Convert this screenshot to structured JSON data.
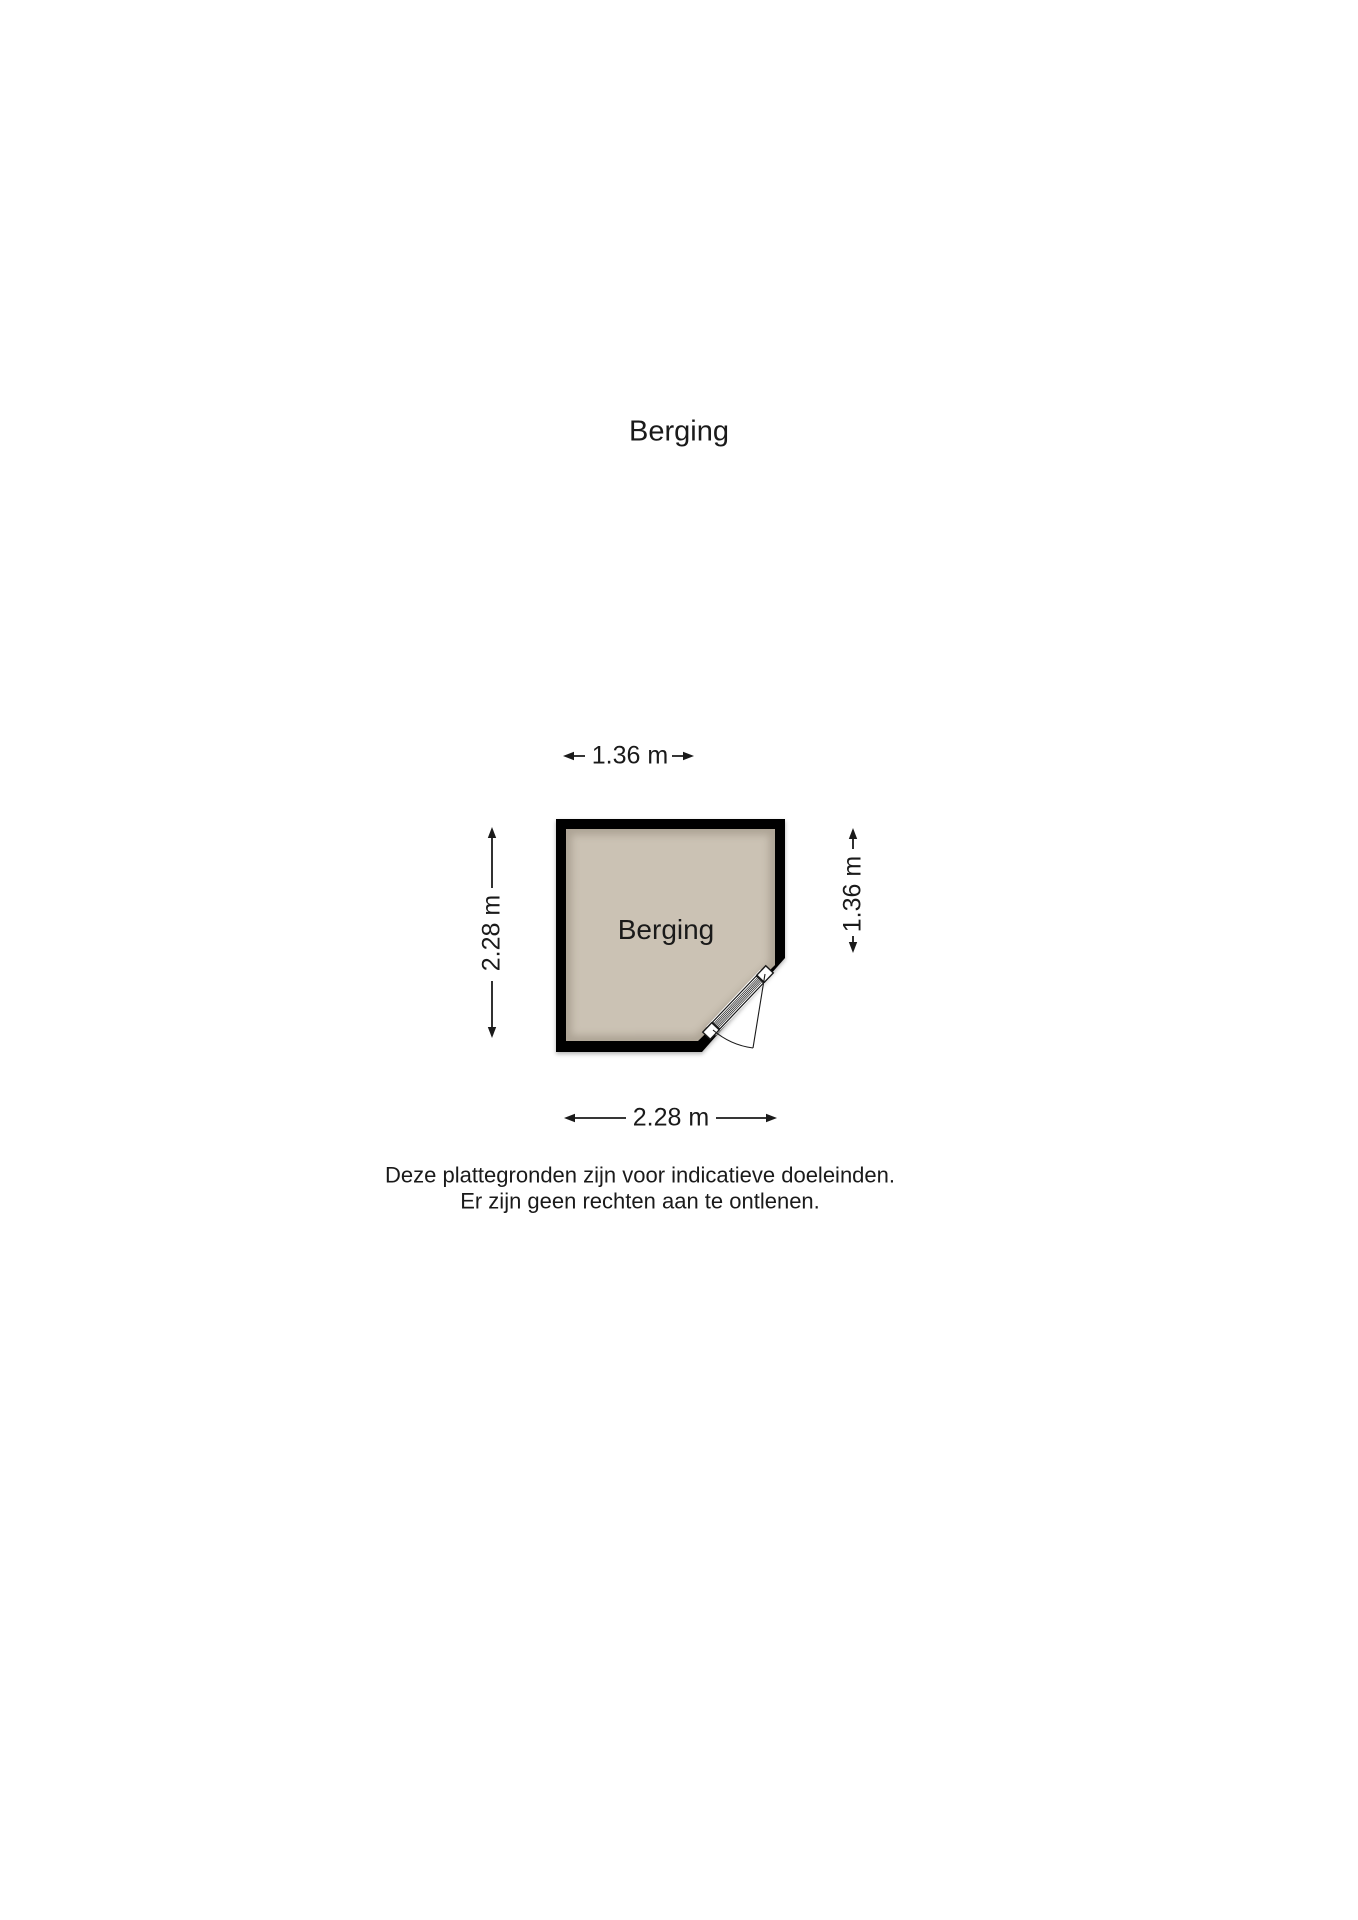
{
  "page": {
    "title": "Berging"
  },
  "floor_plan": {
    "room_label": "Berging",
    "colors": {
      "floor": "#cbc2b4",
      "wall": "#000000",
      "door": "#ffffff",
      "line": "#1a1a1a"
    },
    "dimensions": {
      "top": "1.36 m",
      "bottom": "2.28 m",
      "left": "2.28 m",
      "right": "1.36 m"
    }
  },
  "disclaimer": {
    "line1": "Deze plattegronden zijn voor indicatieve doeleinden.",
    "line2": "Er zijn geen rechten aan te ontlenen."
  }
}
